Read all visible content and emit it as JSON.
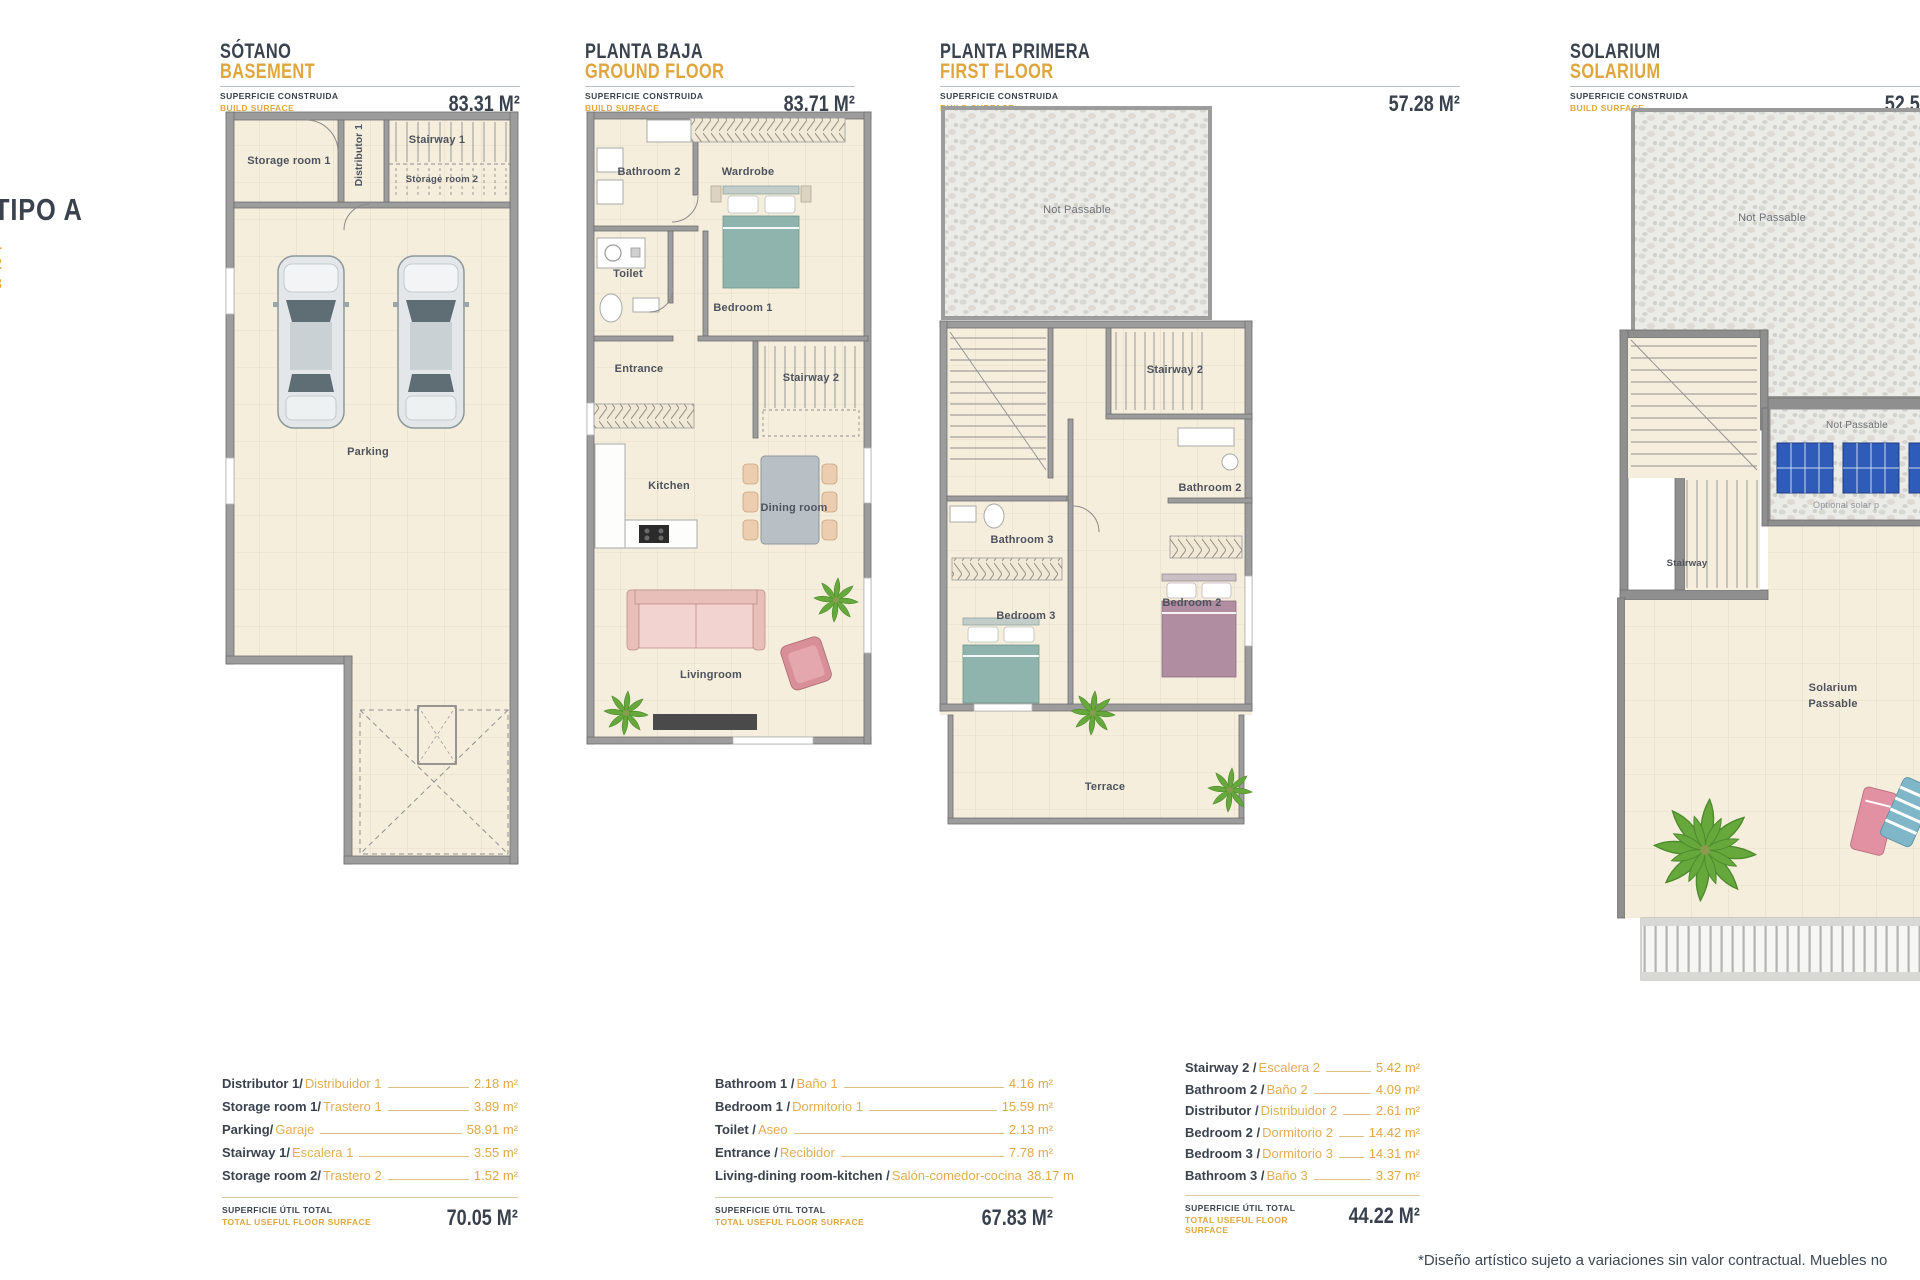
{
  "type_label": {
    "title": "TIPO A",
    "units": [
      "1",
      "2",
      "3"
    ]
  },
  "common": {
    "surface_es": "SUPERFICIE CONSTRUIDA",
    "surface_en": "BUILD SURFACE",
    "total_es": "SUPERFICIE ÚTIL TOTAL",
    "total_en": "TOTAL USEFUL FLOOR SURFACE"
  },
  "panels": [
    {
      "title_es": "SÓTANO",
      "title_en": "BASEMENT",
      "surface_value": "83.31 M²",
      "rooms": {
        "storage1": "Storage room 1",
        "distributor1": "Distributor 1",
        "stairway1": "Stairway 1",
        "storage2": "Storage room 2",
        "parking": "Parking"
      },
      "legend": {
        "rows": [
          {
            "en": "Distributor 1/",
            "es": "Distribuidor 1",
            "value": "2.18 m²"
          },
          {
            "en": "Storage room 1/",
            "es": "Trastero 1",
            "value": "3.89 m²"
          },
          {
            "en": "Parking/",
            "es": "Garaje",
            "value": "58.91 m²"
          },
          {
            "en": "Stairway 1/",
            "es": "Escalera 1",
            "value": "3.55 m²"
          },
          {
            "en": "Storage room 2/",
            "es": "Trastero 2",
            "value": "1.52 m²"
          }
        ],
        "total_value": "70.05 M²"
      }
    },
    {
      "title_es": "PLANTA BAJA",
      "title_en": "GROUND FLOOR",
      "surface_value": "83.71 M²",
      "rooms": {
        "bathroom2": "Bathroom 2",
        "wardrobe": "Wardrobe",
        "toilet": "Toilet",
        "bedroom1": "Bedroom 1",
        "entrance": "Entrance",
        "stairway2": "Stairway 2",
        "kitchen": "Kitchen",
        "dining": "Dining room",
        "living": "Livingroom"
      },
      "legend": {
        "rows": [
          {
            "en": "Bathroom 1 / ",
            "es": "Baño 1",
            "value": "4.16 m²"
          },
          {
            "en": "Bedroom 1 / ",
            "es": "Dormitorio 1",
            "value": "15.59 m²"
          },
          {
            "en": "Toilet / ",
            "es": "Aseo",
            "value": "2.13 m²"
          },
          {
            "en": "Entrance / ",
            "es": "Recibidor",
            "value": "7.78 m²"
          },
          {
            "en": "Living-dining room-kitchen / ",
            "es": "Salón-comedor-cocina",
            "value": "38.17 m"
          }
        ],
        "total_value": "67.83 M²"
      }
    },
    {
      "title_es": "PLANTA PRIMERA",
      "title_en": "FIRST FLOOR",
      "surface_value": "57.28 M²",
      "rooms": {
        "not_passable": "Not Passable",
        "stairway2": "Stairway 2",
        "bathroom2": "Bathroom 2",
        "bathroom3": "Bathroom 3",
        "bedroom3": "Bedroom 3",
        "bedroom2": "Bedroom 2",
        "terrace": "Terrace"
      },
      "legend": {
        "rows": [
          {
            "en": "Stairway 2 / ",
            "es": "Escalera 2",
            "value": "5.42 m²"
          },
          {
            "en": "Bathroom 2 / ",
            "es": "Baño 2",
            "value": "4.09 m²"
          },
          {
            "en": "Distributor / ",
            "es": "Distribuidor 2",
            "value": "2.61 m²"
          },
          {
            "en": "Bedroom 2 / ",
            "es": "Dormitorio 2",
            "value": "14.42 m²"
          },
          {
            "en": "Bedroom 3 / ",
            "es": "Dormitorio 3",
            "value": "14.31 m²"
          },
          {
            "en": "Bathroom 3 / ",
            "es": "Baño 3",
            "value": "3.37 m²"
          }
        ],
        "total_value": "44.22 M²"
      }
    },
    {
      "title_es": "SOLARIUM",
      "title_en": "SOLARIUM",
      "surface_value": "52,5",
      "rooms": {
        "not_passable_top": "Not Passable",
        "not_passable_panels": "Not Passable",
        "optional_panels": "Optional solar p",
        "stairway": "Stairway",
        "solarium_passable": "Solarium\nPassable"
      }
    }
  ],
  "disclaimer": "*Diseño artístico sujeto a variaciones sin valor contractual. Muebles no"
}
